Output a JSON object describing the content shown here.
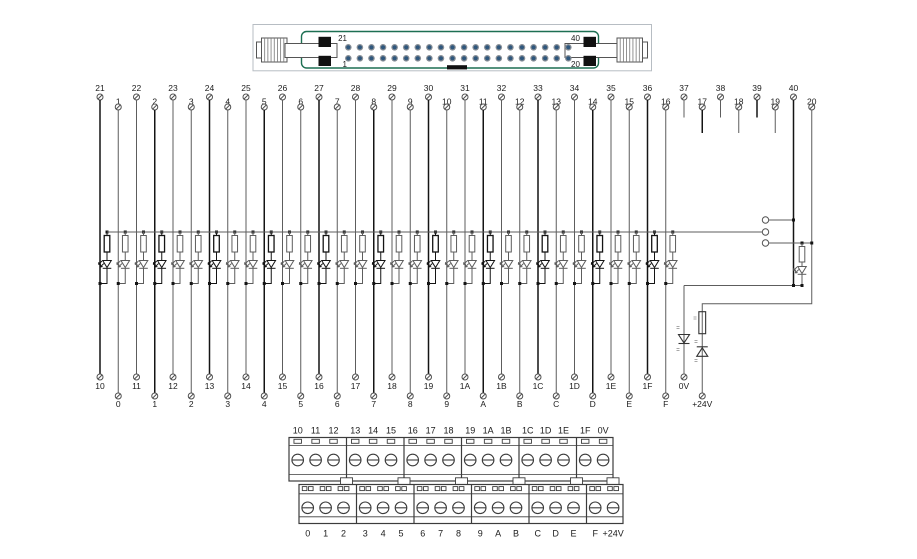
{
  "colors": {
    "background": "#ffffff",
    "wire_dark": "#141414",
    "wire_gray": "#5d5d5d",
    "symbol": "#333333",
    "label": "#1c1c1c",
    "mark": "#8a8a8a",
    "block": "#3c3c3c",
    "connector_border": "#1d6f52",
    "connector_outer": "#b7bdc3",
    "pin_ring": "#8a9097",
    "pin_core": "#2f577d"
  },
  "connector": {
    "corner_labels": {
      "top_left": "21",
      "bottom_left": "1",
      "top_right": "40",
      "bottom_right": "20"
    },
    "pins_per_row": 20
  },
  "channels": [
    {
      "top": "21",
      "bottom": "10"
    },
    {
      "top": "1",
      "bottom": "0"
    },
    {
      "top": "22",
      "bottom": "11"
    },
    {
      "top": "2",
      "bottom": "1"
    },
    {
      "top": "23",
      "bottom": "12"
    },
    {
      "top": "3",
      "bottom": "2"
    },
    {
      "top": "24",
      "bottom": "13"
    },
    {
      "top": "4",
      "bottom": "3"
    },
    {
      "top": "25",
      "bottom": "14"
    },
    {
      "top": "5",
      "bottom": "4"
    },
    {
      "top": "26",
      "bottom": "15"
    },
    {
      "top": "6",
      "bottom": "5"
    },
    {
      "top": "27",
      "bottom": "16"
    },
    {
      "top": "7",
      "bottom": "6"
    },
    {
      "top": "28",
      "bottom": "17"
    },
    {
      "top": "8",
      "bottom": "7"
    },
    {
      "top": "29",
      "bottom": "18"
    },
    {
      "top": "9",
      "bottom": "8"
    },
    {
      "top": "30",
      "bottom": "19"
    },
    {
      "top": "10",
      "bottom": "9"
    },
    {
      "top": "31",
      "bottom": "1A"
    },
    {
      "top": "11",
      "bottom": "A"
    },
    {
      "top": "32",
      "bottom": "1B"
    },
    {
      "top": "12",
      "bottom": "B"
    },
    {
      "top": "33",
      "bottom": "1C"
    },
    {
      "top": "13",
      "bottom": "C"
    },
    {
      "top": "34",
      "bottom": "1D"
    },
    {
      "top": "14",
      "bottom": "D"
    },
    {
      "top": "35",
      "bottom": "1E"
    },
    {
      "top": "15",
      "bottom": "E"
    },
    {
      "top": "36",
      "bottom": "1F"
    },
    {
      "top": "16",
      "bottom": "F"
    }
  ],
  "nc_pins": [
    "37",
    "17",
    "38",
    "18",
    "39",
    "19"
  ],
  "power_pins": [
    {
      "label": "40",
      "net": "0V"
    },
    {
      "label": "20",
      "net": "+24V"
    }
  ],
  "power_terminals": {
    "zero_v": "0V",
    "plus_24v": "+24V"
  },
  "terminal_block_top": [
    [
      "10",
      "11",
      "12"
    ],
    [
      "13",
      "14",
      "15"
    ],
    [
      "16",
      "17",
      "18"
    ],
    [
      "19",
      "1A",
      "1B"
    ],
    [
      "1C",
      "1D",
      "1E"
    ],
    [
      "1F",
      "0V"
    ]
  ],
  "terminal_block_bottom": [
    [
      "0",
      "1",
      "2"
    ],
    [
      "3",
      "4",
      "5"
    ],
    [
      "6",
      "7",
      "8"
    ],
    [
      "9",
      "A",
      "B"
    ],
    [
      "C",
      "D",
      "E"
    ],
    [
      "F",
      "+24V"
    ]
  ]
}
